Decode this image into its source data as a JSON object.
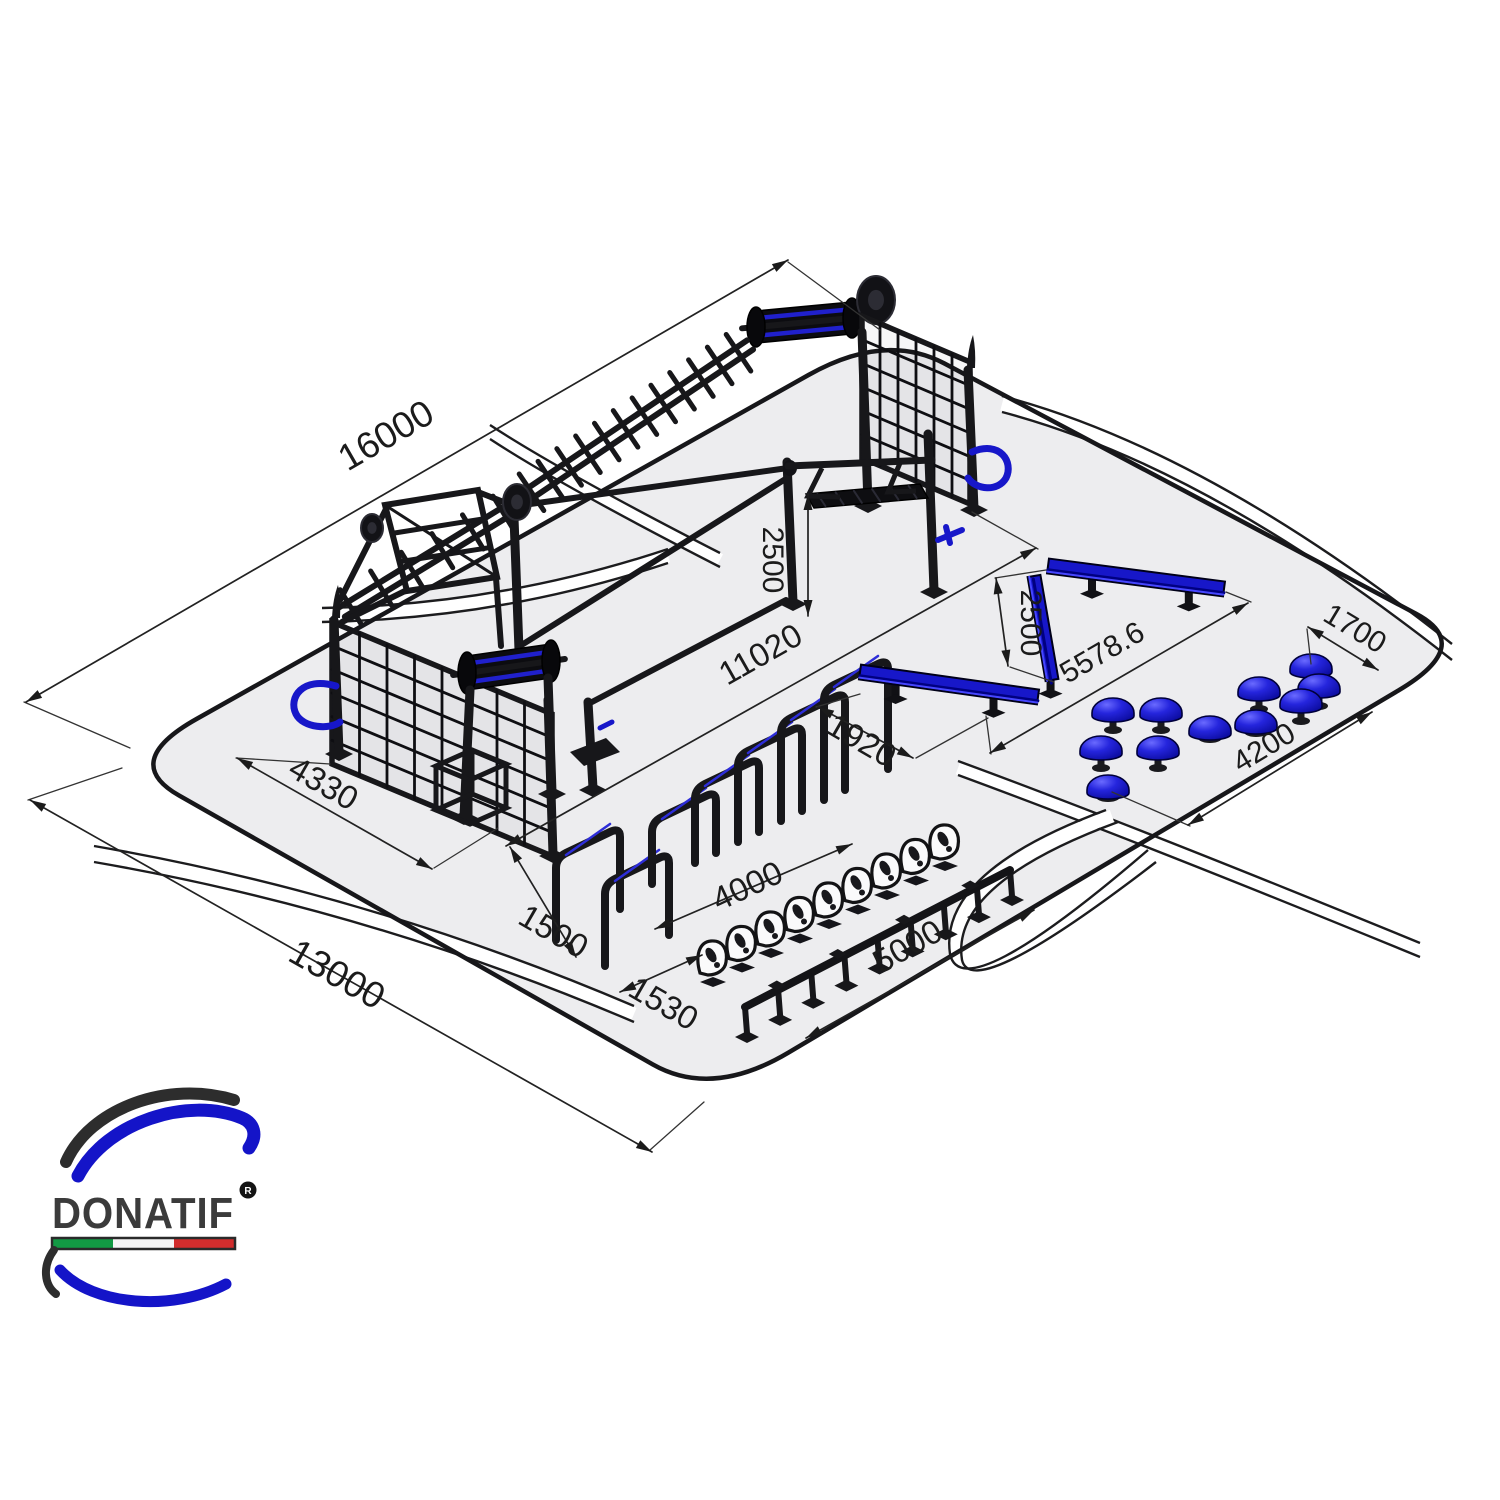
{
  "brand": {
    "wordmark": "DONATIF",
    "registered_mark": "R"
  },
  "logo": {
    "flag_green": "#129a44",
    "flag_white": "#f6f6f6",
    "flag_red": "#d22d2d",
    "swoosh_blue": "#1414c8",
    "swoosh_dark": "#2d2d2d",
    "wordmark_color": "#3b3b3b"
  },
  "drawing": {
    "kind": "isometric installation plan — outdoor calisthenics park",
    "colors": {
      "platform_fill": "#ededef",
      "platform_edge": "#17171a",
      "steel": "#17171a",
      "accent_blue": "#1717c9",
      "dimension_line": "#222222",
      "track_band": "#ffffff"
    },
    "dimensions_mm": {
      "plot_length": "16000",
      "plot_width": "13000",
      "rig_span": "11020",
      "rig_bay_width": "4330",
      "bridge_height": "2500",
      "hurdle_gap": "1500",
      "plate_row_offset": "1530",
      "hurdle_row_length": "4000",
      "balance_rail_length": "5000",
      "low_beam_length": "1920",
      "beam_spacing": "2500",
      "beam_diagonal_span": "5578.6",
      "pod_cluster_gap": "1700",
      "pod_row_length": "4200"
    },
    "equipment": [
      "calisthenics-rig",
      "climbing-net",
      "monkey-bar-ladder",
      "roller-drum",
      "hanging-truss-bridge",
      "tilted-frame",
      "sit-up-bench",
      "grab-handles",
      "balance-beam",
      "steel-hurdles",
      "footprint-steppers",
      "balance-rail",
      "mushroom-pods"
    ]
  }
}
